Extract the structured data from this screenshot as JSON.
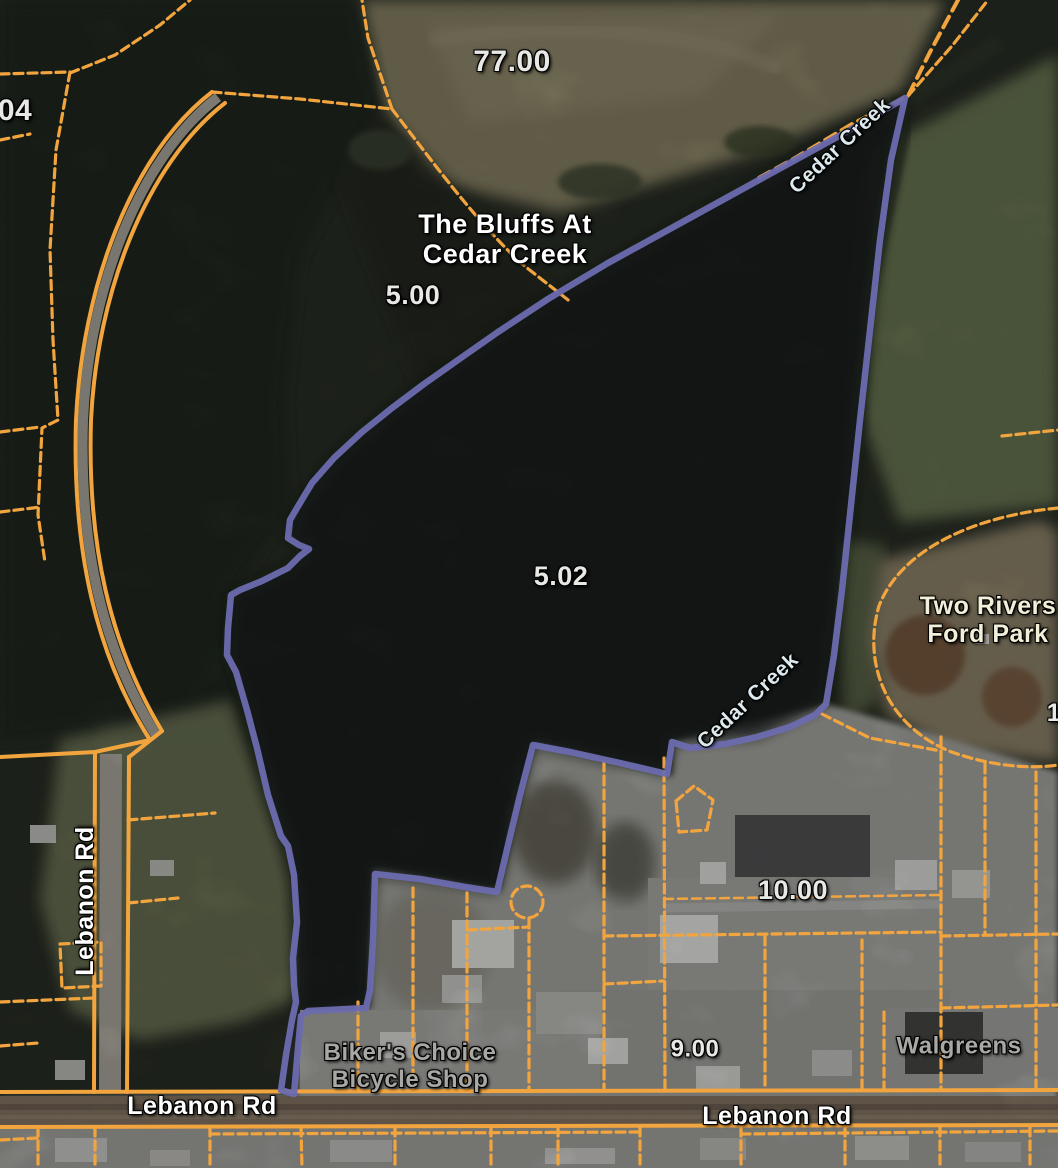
{
  "map": {
    "type": "aerial-parcel-viewer",
    "subject_parcel": "5.02",
    "colors": {
      "parcel_line_orange": "#F2A53E",
      "highlight_parcel_purple": "#6C6CB0",
      "road_fill_brown": "#8D7C69",
      "label_white": "#FFFFFF",
      "label_gray": "#A8A8A5",
      "label_cream": "#F1EFD8",
      "label_blue": "#DDE9EC"
    },
    "labels": {
      "p7700": {
        "text": "77.00"
      },
      "p500": {
        "text": "5.00"
      },
      "p502": {
        "text": "5.02"
      },
      "p1000": {
        "text": "10.00"
      },
      "p900": {
        "text": "9.00"
      },
      "p04": {
        "text": "04"
      },
      "p1": {
        "text": "1"
      },
      "bluffs": {
        "line1": "The Bluffs At",
        "line2": "Cedar Creek"
      },
      "two_rivers": {
        "line1": "Two Rivers",
        "line2": "Ford Park"
      },
      "bikers": {
        "line1": "Biker's Choice",
        "line2": "Bicycle Shop"
      },
      "walgreens": {
        "text": "Walgreens"
      },
      "cedar_creek_upper": {
        "text": "Cedar Creek"
      },
      "cedar_creek_lower": {
        "text": "Cedar Creek"
      },
      "lebanon_rd_west": {
        "text": "Lebanon Rd"
      },
      "lebanon_rd_south_left": {
        "text": "Lebanon Rd"
      },
      "lebanon_rd_south_right": {
        "text": "Lebanon Rd"
      }
    }
  }
}
